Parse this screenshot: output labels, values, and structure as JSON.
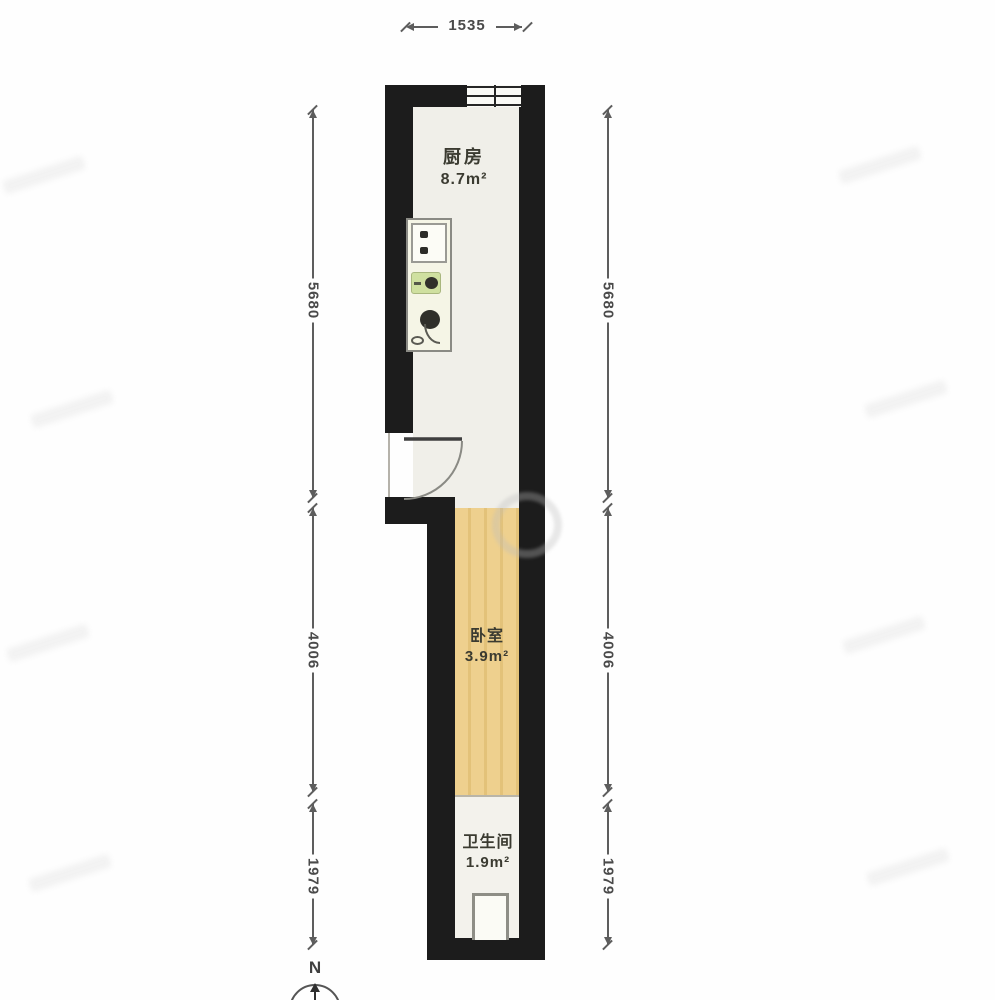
{
  "dimensions": {
    "top": "1535",
    "left": [
      "5680",
      "4006",
      "1979"
    ],
    "right": [
      "5680",
      "4006",
      "1979"
    ]
  },
  "rooms": {
    "kitchen": {
      "name": "厨房",
      "area": "8.7m²"
    },
    "bedroom": {
      "name": "卧室",
      "area": "3.9m²"
    },
    "bathroom": {
      "name": "卫生间",
      "area": "1.9m²"
    }
  },
  "compass": {
    "label": "N"
  },
  "icons": {
    "door": "door-swing-icon",
    "window": "window-icon",
    "stove": "stove-icon",
    "sink": "sink-icon",
    "basin": "basin-icon",
    "shower": "shower-tray-icon",
    "compass": "north-compass-icon"
  },
  "colors": {
    "wall": "#1c1c1c",
    "kitchen_floor": "#f0efe9",
    "bedroom_floor": "#eed08e",
    "bathroom_floor": "#f3f2ec",
    "sink_green": "#cfe0a0",
    "dimension_text": "#4a4a4a",
    "label_text": "#3b3b31"
  }
}
